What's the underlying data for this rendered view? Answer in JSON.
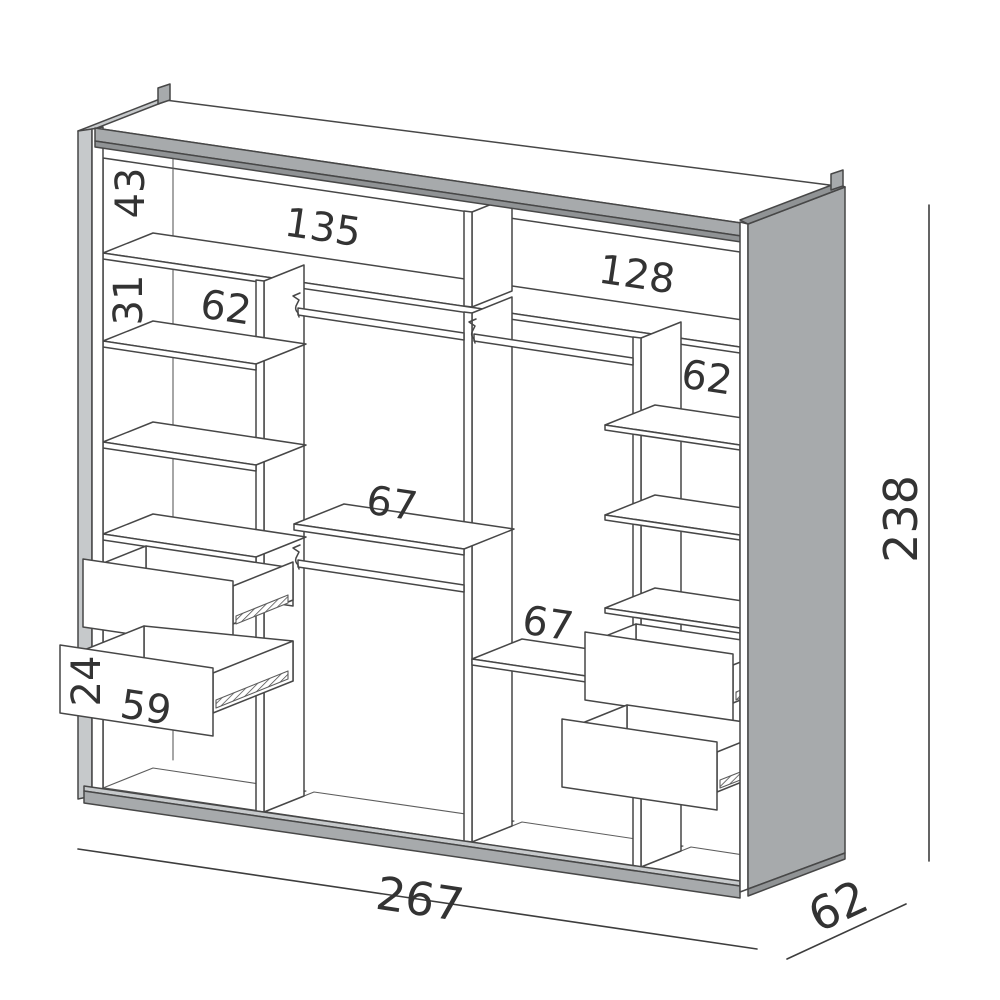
{
  "diagram": {
    "type": "furniture-technical-drawing",
    "subject": "wardrobe interior with shelves, hanging rails and pull-out drawers",
    "colors": {
      "outline": "#474747",
      "panel_gray": "#a7aaac",
      "panel_gray_dark": "#909395",
      "panel_gray_light": "#c6c9cb",
      "background": "#ffffff",
      "label_text": "#333333"
    },
    "dimensions": {
      "top_compartment_height": {
        "value": "43",
        "orientation": "vertical"
      },
      "top_left_compartment_width": {
        "value": "135",
        "orientation": "horizontal"
      },
      "top_right_compartment_width": {
        "value": "128",
        "orientation": "horizontal"
      },
      "left_shelf_spacing": {
        "value": "31",
        "orientation": "vertical"
      },
      "left_shelf_width": {
        "value": "62",
        "orientation": "horizontal"
      },
      "right_shelf_width": {
        "value": "62",
        "orientation": "horizontal"
      },
      "left_hanging_section_width": {
        "value": "67",
        "orientation": "horizontal"
      },
      "right_hanging_section_width": {
        "value": "67",
        "orientation": "horizontal"
      },
      "drawer_front_height": {
        "value": "24",
        "orientation": "vertical"
      },
      "drawer_front_width": {
        "value": "59",
        "orientation": "horizontal"
      },
      "overall_width": {
        "value": "267",
        "orientation": "horizontal"
      },
      "overall_depth": {
        "value": "62",
        "orientation": "oblique"
      },
      "overall_height": {
        "value": "238",
        "orientation": "vertical"
      }
    }
  }
}
